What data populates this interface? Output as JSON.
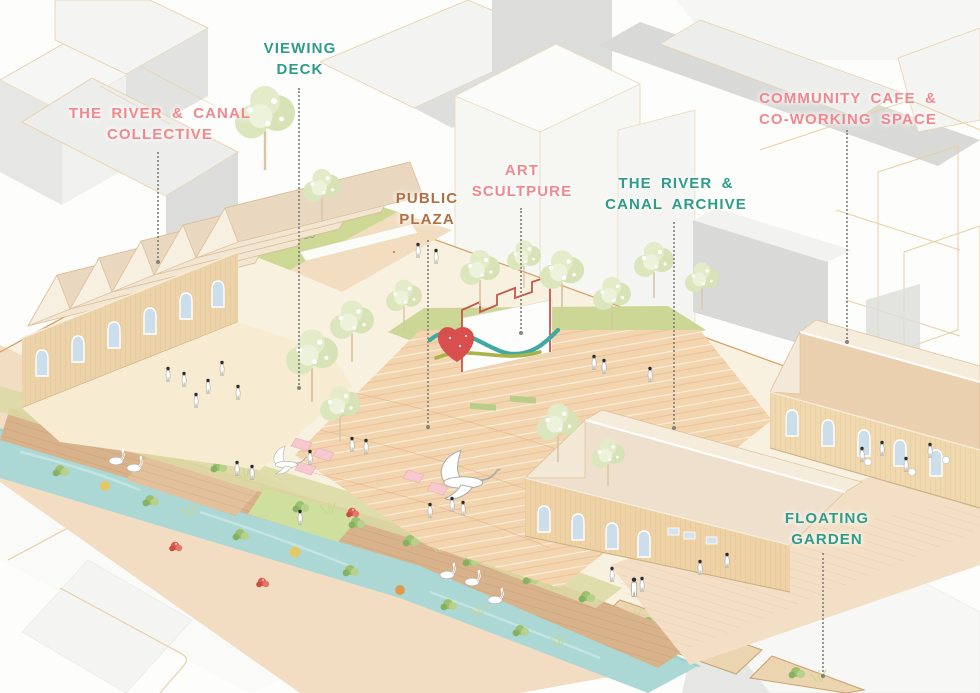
{
  "meta": {
    "description": "Axonometric landscape-architecture illustration of a river & canal regeneration site with annotated program labels",
    "image_width": 980,
    "image_height": 693
  },
  "labels": {
    "collective": {
      "line1": "THE RIVER & CANAL",
      "line2": "COLLECTIVE"
    },
    "viewing_deck": {
      "line1": "VIEWING",
      "line2": "DECK"
    },
    "public_plaza": {
      "line1": "PUBLIC",
      "line2": "PLAZA"
    },
    "art_sculpture": {
      "line1": "ART",
      "line2": "SCULTPURE"
    },
    "archive": {
      "line1": "THE RIVER &",
      "line2": "CANAL ARCHIVE"
    },
    "community_cafe": {
      "line1": "COMMUNITY CAFE &",
      "line2": "CO-WORKING SPACE"
    },
    "floating_garden": {
      "line1": "FLOATING",
      "line2": "GARDEN"
    }
  },
  "palette": {
    "label_teal": "#2d9c88",
    "label_coral": "#f0898e",
    "label_brown": "#b06f44",
    "canal_water": "#abd8d5",
    "warehouse_wall_tan": "#ecd2a8",
    "roof_cream": "#f2e6d2",
    "plaza_terracotta": "#f2d4ae",
    "lawn_green": "#ccd795",
    "boardwalk_wood": "#d8b28b",
    "flower_red": "#d95c52",
    "background_block_grey": "#dcddda",
    "outline_tan": "#e3c69c"
  }
}
